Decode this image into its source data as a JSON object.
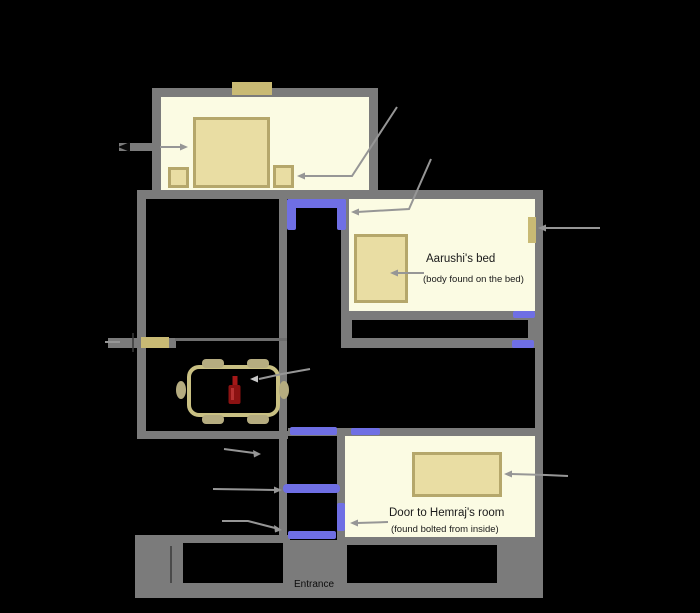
{
  "diagram": {
    "type": "floor-plan",
    "background": "#000000",
    "labels": {
      "aarushi_bed_title": "Aarushi's bed",
      "aarushi_bed_note": "(body found on the bed)",
      "hemraj_door_title": "Door to Hemraj's room",
      "hemraj_door_note": "(found bolted from inside)",
      "entrance": "Entrance"
    },
    "colors": {
      "wall": "#7b7b7b",
      "room_floor": "#FBFBE3",
      "open_door": "#6F6FE4",
      "wood_fixture": "#C9BA74",
      "furniture_fill": "#E9DDA3",
      "furniture_border": "#B5A76B",
      "table_outline": "#C9C083",
      "chair_fill": "#B5AC80",
      "bottle_red": "#8C1212",
      "arrow": "#969696"
    }
  }
}
